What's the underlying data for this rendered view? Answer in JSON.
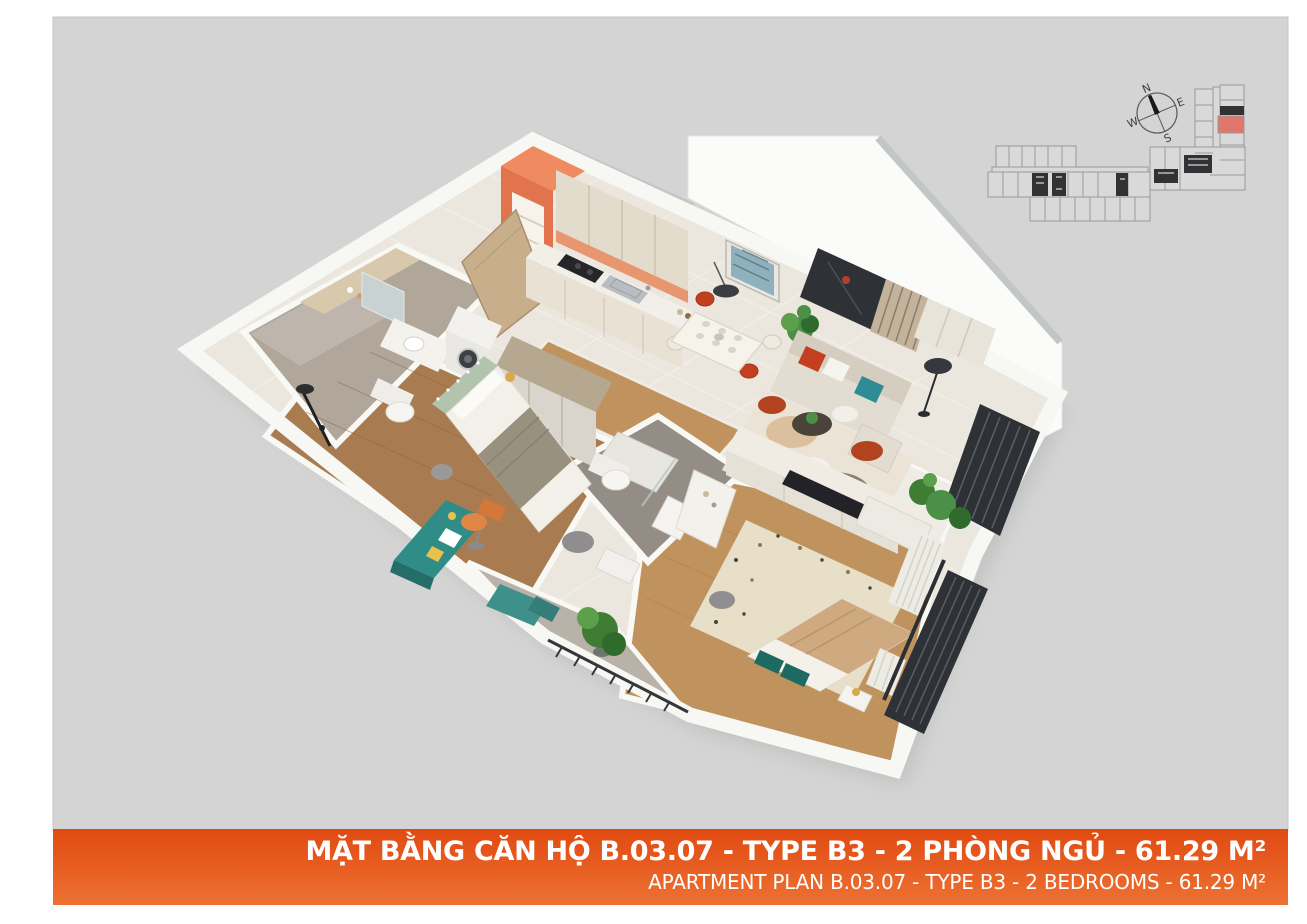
{
  "banner": {
    "title_vi": "MẶT BẰNG CĂN HỘ B.03.07 - TYPE B3 - 2 PHÒNG NGỦ - 61.29 M²",
    "subtitle_en": "APARTMENT PLAN B.03.07 - TYPE B3 - 2 BEDROOMS - 61.29 M²",
    "gradient_top": "#e04a11",
    "gradient_bottom": "#ee7133",
    "text_color": "#ffffff"
  },
  "compass": {
    "north": "N",
    "east": "E",
    "south": "S",
    "west": "W",
    "rotation_deg": -23
  },
  "site_plan": {
    "unit_highlight_color": "#e1766d",
    "building_fill": "#d8d9d8",
    "building_outline": "#97999a",
    "core_color": "#303234"
  },
  "apartment": {
    "unit_code": "B.03.07",
    "type_code": "B3",
    "bedrooms_count": 2,
    "area_m2": "61.29",
    "rooms": [
      "entry",
      "kitchen",
      "dining-area",
      "living-room",
      "loggia",
      "bedroom-1",
      "bedroom-2",
      "bathroom-1",
      "bathroom-2",
      "balcony"
    ]
  },
  "palette": {
    "page": "#ffffff",
    "canvas": "#d3d4d3",
    "wall": "#f7f7f4",
    "slab": "#c3c6c6",
    "floor_tile": "#ece7de",
    "wood_dark": "#a87c50",
    "wood_light": "#c0935e",
    "bath1_floor": "#b0a79a",
    "bath2_floor": "#948d85",
    "balcony_floor": "#b8b2a8",
    "accent_orange": "#e2744d",
    "kitchen_cabinet": "#e3dbcb",
    "backsplash": "#e8966f",
    "sofa": "#e3dcd0",
    "rug": "#eae3d6",
    "red": "#c2401f",
    "rust": "#b3431f",
    "teal": "#2d8c94",
    "teal_dark": "#1d6a62",
    "sage": "#b2c4ae",
    "desk_teal": "#2f8c86",
    "plant": "#4c8f46",
    "dark_panel": "#2e3237",
    "curtain": "#ecebe4",
    "duvet_tan": "#cfa97f",
    "wardrobe": "#d9d5cd"
  }
}
